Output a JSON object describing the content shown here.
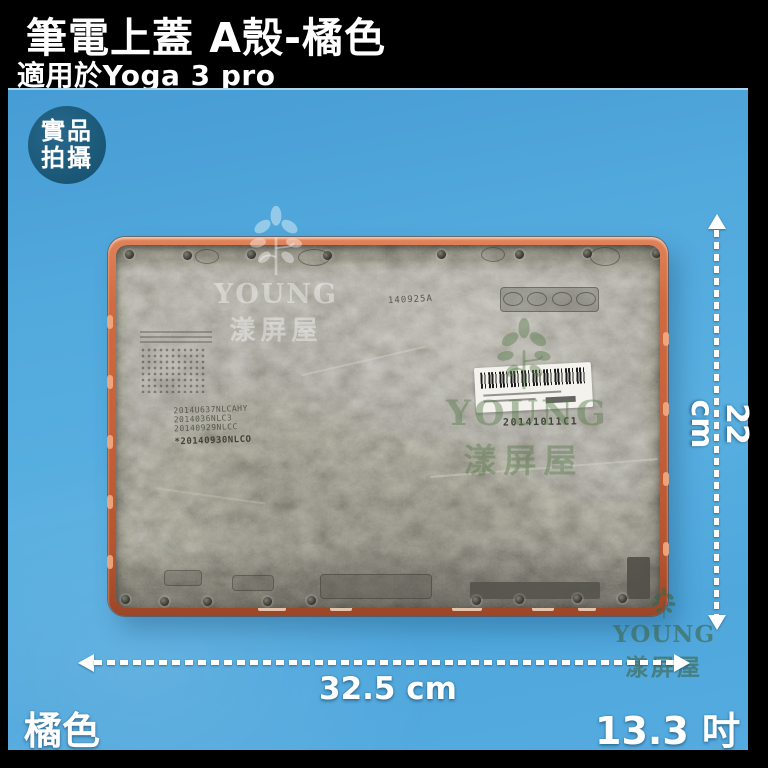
{
  "header": {
    "title": "筆電上蓋 A殼-橘色",
    "subtitle": "適用於Yoga 3 pro"
  },
  "photo": {
    "badge": {
      "line1": "實品",
      "line2": "拍攝"
    },
    "annotations": {
      "height_label": "22 cm",
      "width_label": "32.5 cm",
      "color_label": "橘色",
      "size_label": "13.3 吋"
    },
    "cover_markings": {
      "mold_code": "140925A",
      "stamp_line1": "2014U637NLCAHY",
      "stamp_line2": "2014036NLC3",
      "stamp_line3": "20140929NLCC",
      "stamp_line4": "*20140930NLCO",
      "qc_code": "20141011C1"
    },
    "watermark": {
      "brand": "YOUNG",
      "brand_cn": "漾屏屋"
    }
  },
  "colors": {
    "background_black": "#000000",
    "photo_blue": "#53a9dd",
    "badge_blue": "#1d5c7c",
    "cover_orange": "#c35f38",
    "cover_gray": "#8b897e",
    "annotation_white": "#ffffff",
    "watermark_green": "#587c4c"
  }
}
